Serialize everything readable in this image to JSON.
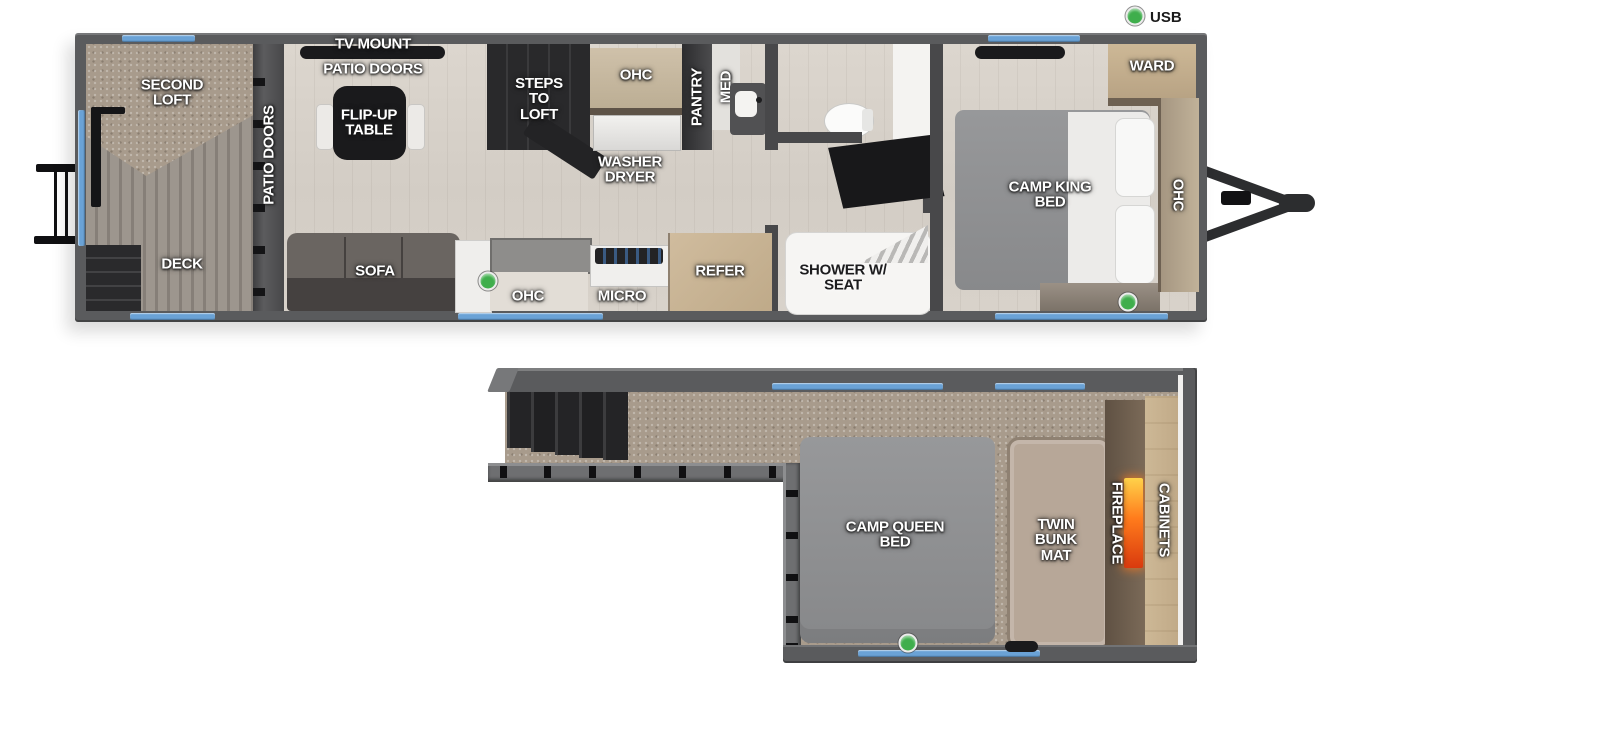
{
  "legend": {
    "usb": "USB"
  },
  "colors": {
    "wall": "#5a5b5d",
    "window_accent": "#6aa2d6",
    "wood_floor": "#d8d2c9",
    "carpet": "#a89b8c",
    "cabinet_tan": "#c7b296",
    "dark_furniture": "#1a1a1c",
    "bed_gray": "#909193",
    "bunk_mat": "#b7a798",
    "fireplace_glow": "#ff7b1c",
    "usb_green": "#3fae4c"
  },
  "main_floor": {
    "labels": {
      "tv_mount": "TV MOUNT",
      "patio_doors_top": "PATIO DOORS",
      "patio_doors_side": "PATIO DOORS",
      "second_loft": "SECOND LOFT",
      "deck": "DECK",
      "flip_up_table": "FLIP-UP TABLE",
      "sofa": "SOFA",
      "steps_to_loft": "STEPS TO LOFT",
      "ohc_upper": "OHC",
      "washer_dryer": "WASHER DRYER",
      "pantry": "PANTRY",
      "med": "MED",
      "ohc_kitchen": "OHC",
      "micro": "MICRO",
      "refer": "REFER",
      "shower_w_seat": "SHOWER W/ SEAT",
      "camp_king_bed": "CAMP KING BED",
      "ward": "WARD",
      "ohc_bedroom": "OHC"
    }
  },
  "second_floor": {
    "labels": {
      "camp_queen_bed": "CAMP QUEEN BED",
      "twin_bunk_mat": "TWIN BUNK MAT",
      "fireplace": "FIREPLACE",
      "cabinets": "CABINETS"
    }
  }
}
